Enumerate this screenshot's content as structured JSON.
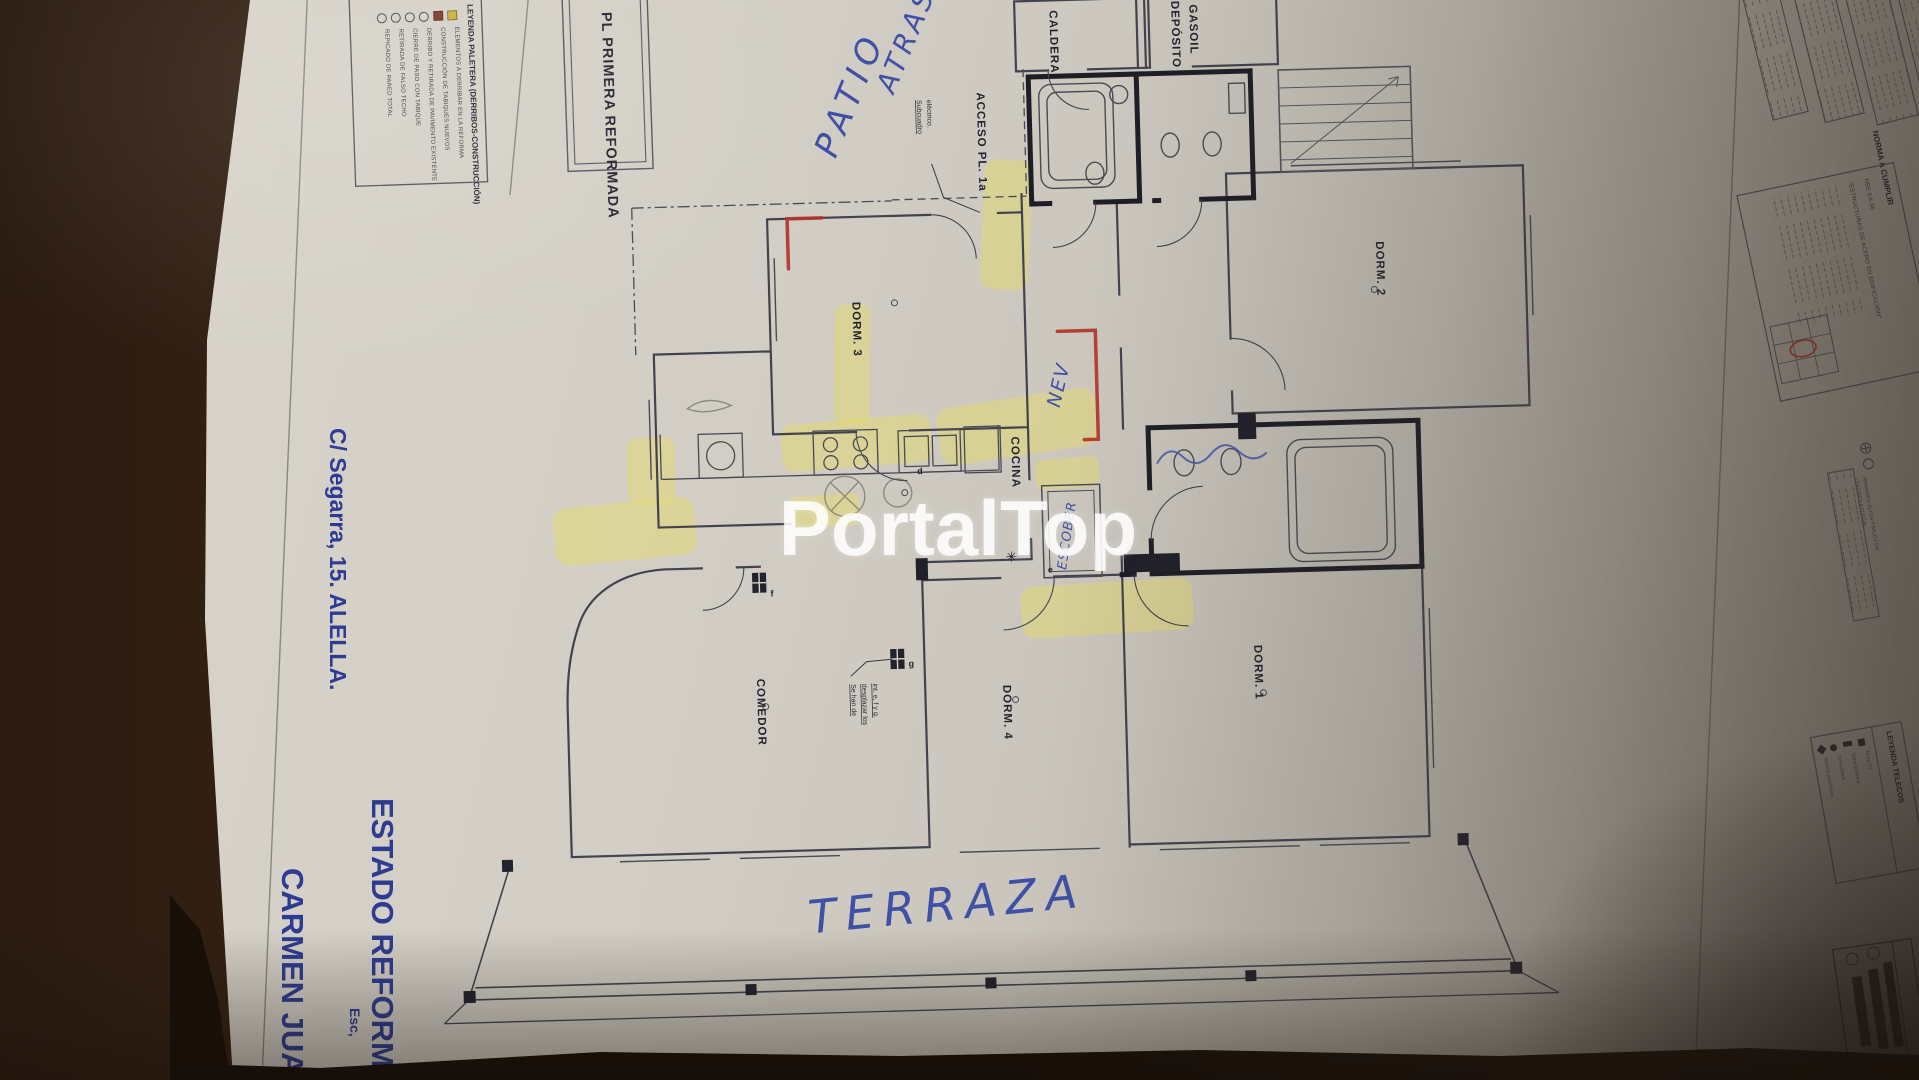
{
  "watermark": "PortalTop",
  "colors": {
    "print_blue": "#2d3c92",
    "pen_blue": "#3f51a6",
    "marker_red": "#b2332b",
    "highlighter_yellow": "#e6dc64",
    "paper": "#cdc9c0",
    "table_wood": "#3f2817"
  },
  "titleblock": {
    "plan_title": "PL PRIMERA REFORMADA",
    "address": "C/ Segarra, 15. ALELLA.",
    "scale_label": "Esc,",
    "status_title": "ESTADO REFORMA",
    "client_name": "CARMEN JUAR"
  },
  "legend_paletera": {
    "title": "LEYENDA PALETERA (DERRIBOS-CONSTRUCCIÓN)",
    "items": [
      {
        "text": "ELEMENTOS A DERRIBAR EN LA REFORMA",
        "marker": "square-yellow"
      },
      {
        "text": "CONSTRUCCIÓN DE TABIQUES NUEVOS",
        "marker": "square-maroon"
      },
      {
        "text": "DERRIBO Y RETIRADA DE PAVIMENTO EXISTENTE",
        "marker": "circle"
      },
      {
        "text": "CIERRE DE PASO CON TABIQUE",
        "marker": "circle"
      },
      {
        "text": "RETIRADA DE FALSO TECHO",
        "marker": "circle"
      },
      {
        "text": "REPICADO DE PARED TOTAL",
        "marker": "circle"
      }
    ]
  },
  "rooms": {
    "dorm1": "DORM. 1",
    "dorm2": "DORM. 2",
    "dorm3": "DORM. 3",
    "dorm4": "DORM. 4",
    "comedor": "COMEDOR",
    "cocina": "COCINA",
    "caldera": "CALDERA",
    "deposito_line1": "DEPÓSITO",
    "deposito_line2": "GASOIL"
  },
  "plan_labels": {
    "acceso": "ACCESO PL. 1a",
    "subcuadro_line1": "Subcuadro",
    "subcuadro_line2": "eléctrico.",
    "note_line1": "Se han de",
    "note_line2": "desplazar los",
    "note_line3": "int. e, f y g.",
    "letters": [
      "d",
      "e",
      "f",
      "g"
    ],
    "asterisk": "✳"
  },
  "handwriting": {
    "patio": "PATIO",
    "atras": "ATRAS",
    "nev": "NEV",
    "escober": "ESCOBER",
    "terraza": "TERRAZA"
  },
  "right_panels": {
    "norma_title": "NORMA A CUMPLIR",
    "norma_line1": "NBE EA-95",
    "norma_line2": "\"ESTRUCTURAS DE ACERO EN EDIFICACIÓN\"",
    "notes_line1": "ARMARIOS ALTOS Y BAJOS EN",
    "notes_line2": "COLORES A ELEGIR",
    "telecos_title": "LEYENDA TELECOS",
    "telecos_items": [
      "Toma TV",
      "Toma teléfono",
      "Toma datos",
      "Antena parabólica"
    ]
  }
}
